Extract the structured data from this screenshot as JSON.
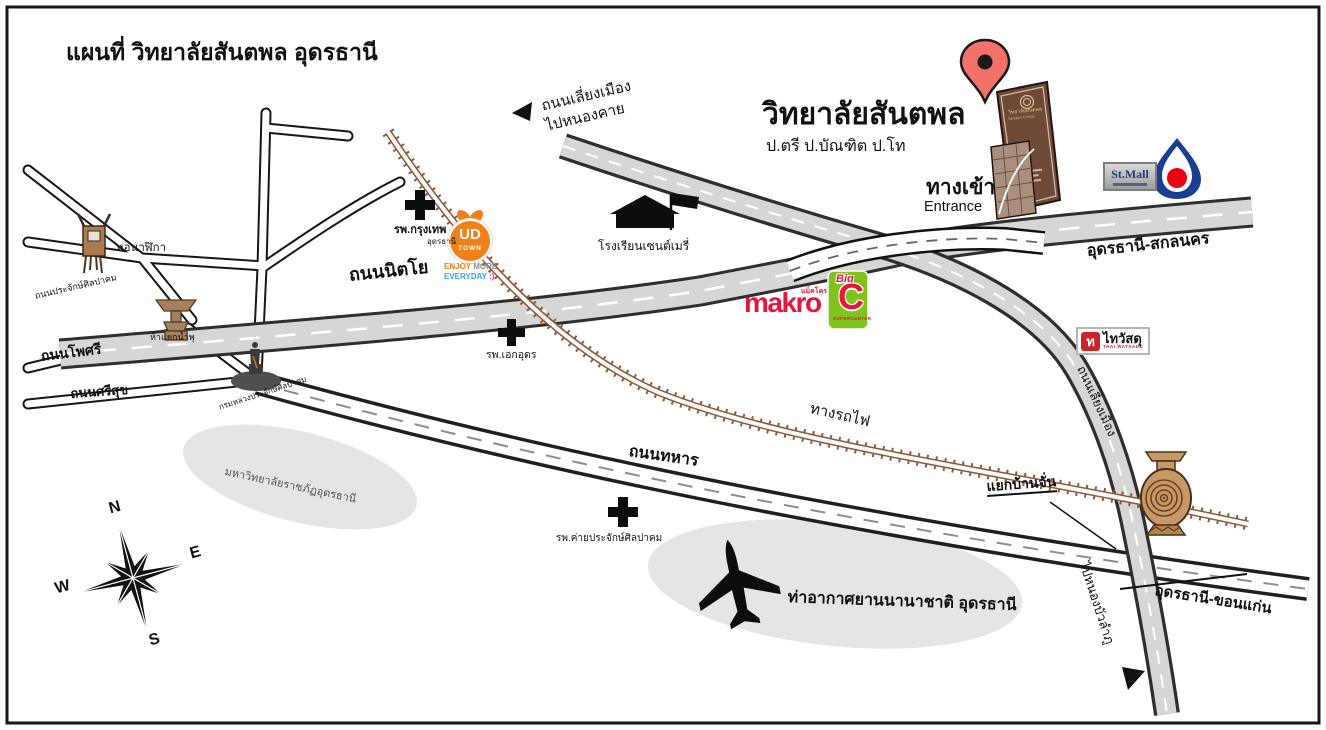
{
  "title": "แผนที่ วิทยาลัยสันตพล อุดรธานี",
  "college": {
    "name": "วิทยาลัยสันตพล",
    "degrees": "ป.ตรี  ป.บัณฑิต  ป.โท",
    "entrance_th": "ทางเข้า",
    "entrance_en": "Entrance",
    "sign_line1": "วิทยาลัยสันตพล",
    "sign_line2": "Santapol College"
  },
  "roads": {
    "nittayo": "ถนนนิตโย",
    "udon_sakon": "อุดรธานี-สกลนคร",
    "udon_khonkaen": "อุดรธานี-ขอนแก่น",
    "thahan": "ถนนทหาร",
    "phosri": "ถนนโพศรี",
    "srisuk": "ถนนศรีสุข",
    "prajak_silpakhom": "ถนนประจักษ์ศิลปาคม",
    "bypass_line1": "ถนนเลี่ยงเมือง",
    "bypass_line2": "ไปหนองคาย",
    "bypass_east": "ถนนเลี่ยงเมือง",
    "to_nong_bua_lamphu": "ไปหนองบัวลำภู",
    "railway": "ทางรถไฟ",
    "ban_chan_junction": "แยกบ้านจั่น"
  },
  "places": {
    "clock_tower": "หอนาฬิกา",
    "fountain_junction": "ห้าแยกน้ำพุ",
    "bangkok_hospital": "รพ.กรุงเทพ",
    "bangkok_hospital_sub": "อุดรธานี",
    "st_mary_school": "โรงเรียนเซนต์เมรี่",
    "aek_udon_hospital": "รพ.เอกอุดร",
    "prajak_monument": "กรมหลวงประจักษ์ศิลปาคม",
    "rajabhat_university": "มหาวิทยาลัยราชภัฏอุดรธานี",
    "camp_hospital": "รพ.ค่ายประจักษ์ศิลปาคม",
    "airport": "ท่าอากาศยานนานาชาติ อุดรธานี"
  },
  "logos": {
    "ud_town": {
      "abbr": "UD",
      "town": "TOWN",
      "enjoy": "ENJOY",
      "more": "MORE",
      "everyday": "EVERYDAY",
      "smiley": ":)"
    },
    "makro": {
      "name": "makro",
      "thai": "แม็คโคร"
    },
    "big_c": {
      "big": "Big",
      "c": "C",
      "sub": "SUPERCENTER"
    },
    "st_mall": {
      "name": "St.Mall"
    },
    "thai_watsadu": {
      "thai_char": "ท",
      "thai": "ไทวัสดุ",
      "en": "THAI WATSADU"
    }
  },
  "compass": {
    "n": "N",
    "e": "E",
    "s": "S",
    "w": "W"
  },
  "colors": {
    "road_fill": "#d6d6d6",
    "road_edge": "#2e2e2e",
    "railway_brown": "#8a5a3c",
    "pin_red": "#f4716a",
    "monument_brown": "#6f4a36",
    "ud_town_orange": "#f08019",
    "makro_red": "#e2173d",
    "big_c_green": "#7fc31c",
    "big_c_red": "#e31837",
    "ptt_blue": "#1b3e93",
    "ptt_red": "#e60012",
    "thai_watsadu_red": "#cc2229",
    "area_gray": "#e5e5e5"
  }
}
